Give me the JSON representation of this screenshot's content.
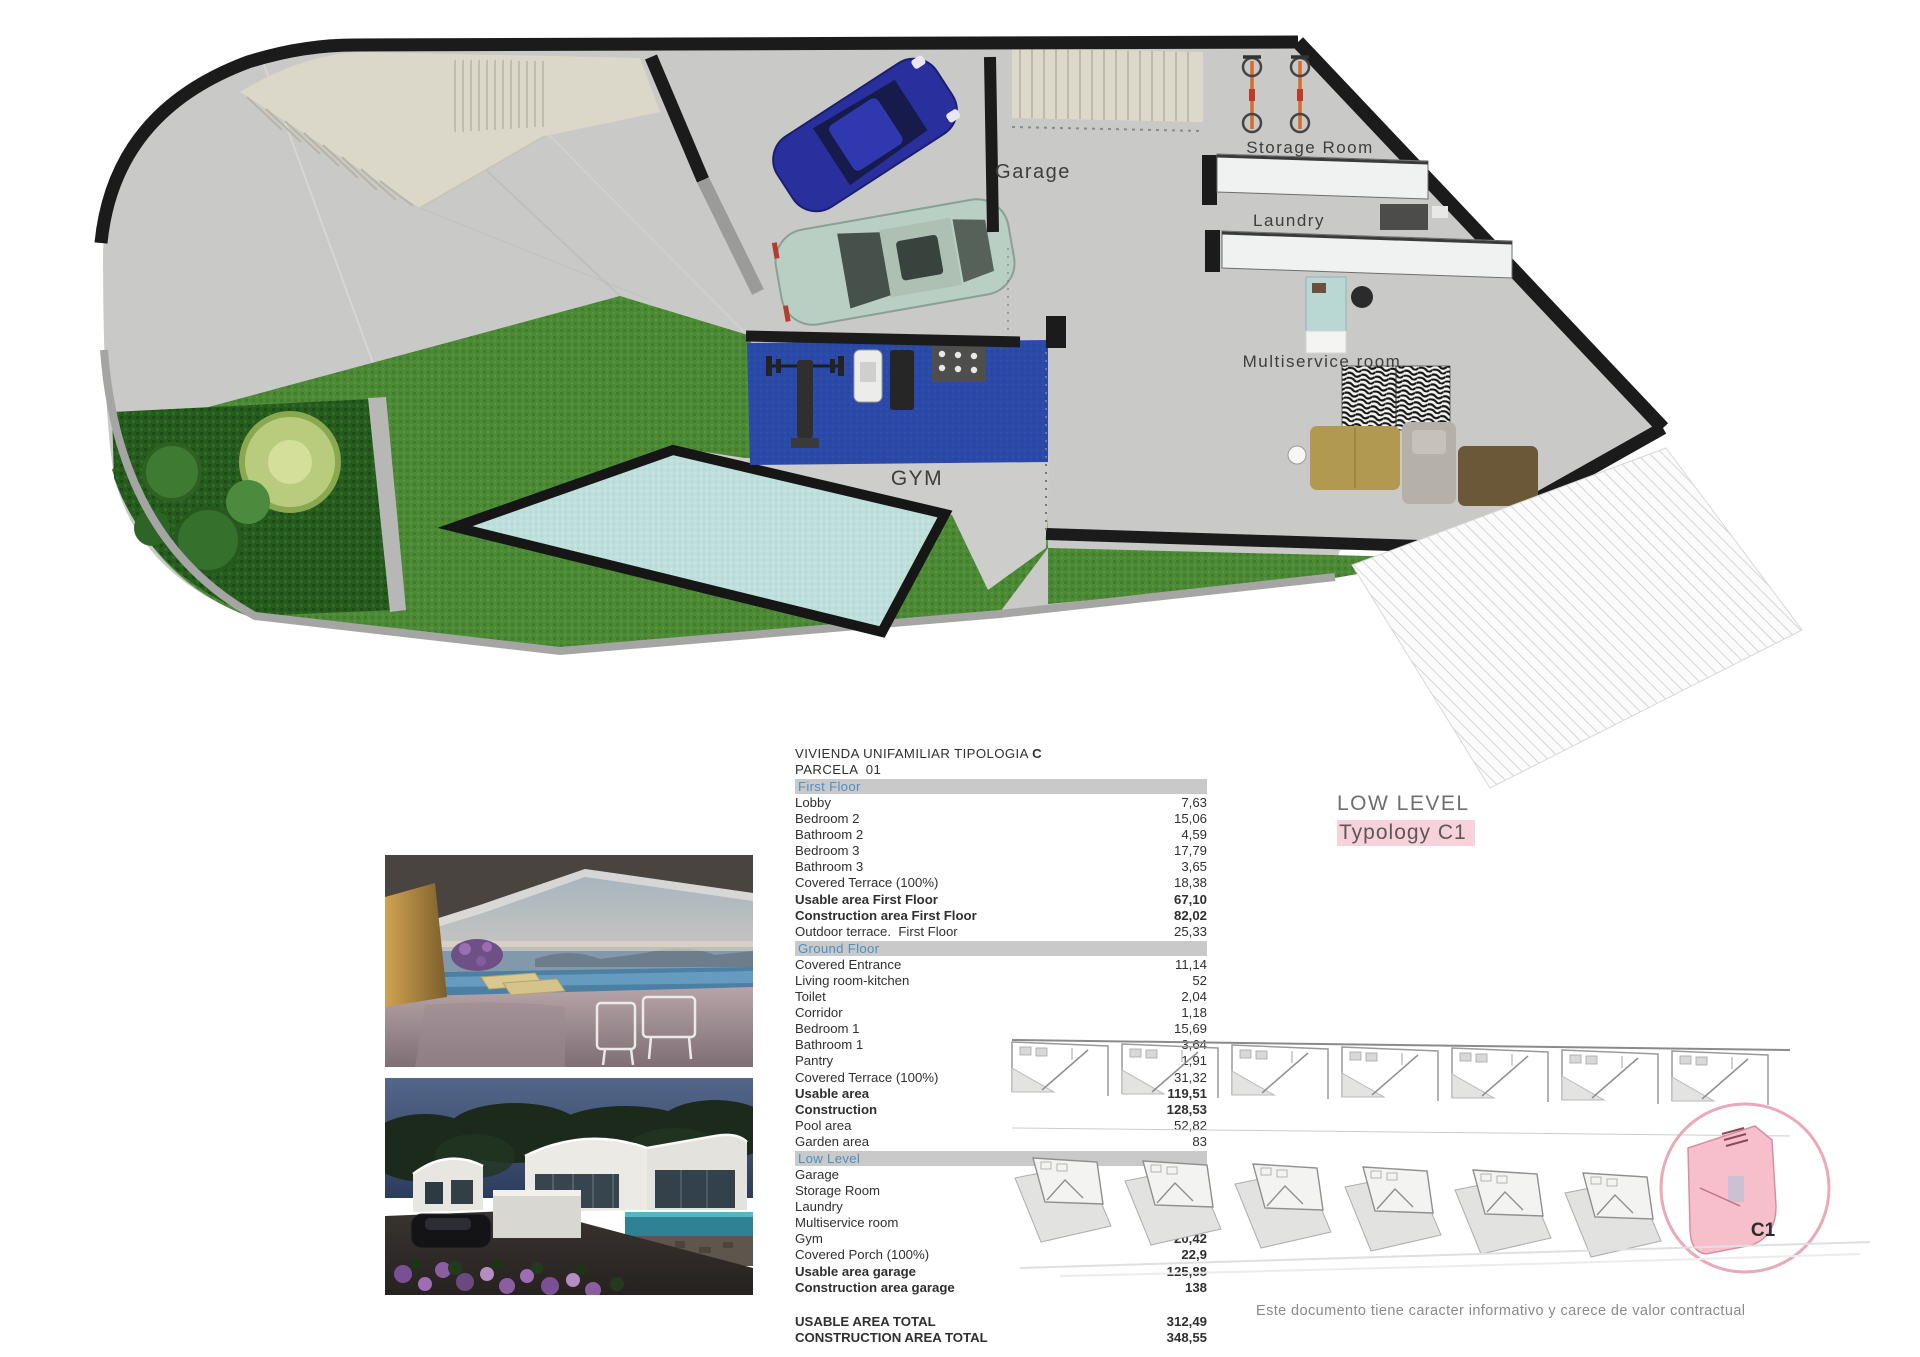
{
  "plan": {
    "labels": {
      "garage": "Garage",
      "storage": "Storage Room",
      "laundry": "Laundry",
      "multiservice": "Multiservice room",
      "gym": "GYM"
    }
  },
  "area_table": {
    "title": "VIVIENDA UNIFAMILIAR TIPOLOGIA",
    "typology": "C",
    "subtitle": "PARCELA  01",
    "sections": [
      {
        "name": "First Floor",
        "rows": [
          {
            "label": "Lobby",
            "value": "7,63",
            "bold": "none"
          },
          {
            "label": "Bedroom 2",
            "value": "15,06",
            "bold": "none"
          },
          {
            "label": "Bathroom 2",
            "value": "4,59",
            "bold": "none"
          },
          {
            "label": "Bedroom 3",
            "value": "17,79",
            "bold": "none"
          },
          {
            "label": "Bathroom 3",
            "value": "3,65",
            "bold": "none"
          },
          {
            "label": "Covered Terrace (100%)",
            "value": "18,38",
            "bold": "none"
          },
          {
            "label": "Usable area First Floor",
            "value": "67,10",
            "bold": "both"
          },
          {
            "label": "Construction area First Floor",
            "value": "82,02",
            "bold": "both"
          },
          {
            "label": "Outdoor terrace.  First Floor",
            "value": "25,33",
            "bold": "none"
          }
        ]
      },
      {
        "name": "Ground Floor",
        "rows": [
          {
            "label": "Covered Entrance",
            "value": "11,14",
            "bold": "none"
          },
          {
            "label": "Living room-kitchen",
            "value": "52",
            "bold": "none"
          },
          {
            "label": "Toilet",
            "value": "2,04",
            "bold": "none"
          },
          {
            "label": "Corridor",
            "value": "1,18",
            "bold": "none"
          },
          {
            "label": "Bedroom 1",
            "value": "15,69",
            "bold": "none"
          },
          {
            "label": "Bathroom 1",
            "value": "3,64",
            "bold": "none"
          },
          {
            "label": "Pantry",
            "value": "1,91",
            "bold": "none"
          },
          {
            "label": "Covered Terrace (100%)",
            "value": "31,32",
            "bold": "none"
          },
          {
            "label": "Usable area",
            "value": "119,51",
            "bold": "both"
          },
          {
            "label": "Construction",
            "value": "128,53",
            "bold": "both"
          },
          {
            "label": "Pool area",
            "value": "52,82",
            "bold": "none"
          },
          {
            "label": "Garden area",
            "value": "83",
            "bold": "none"
          }
        ]
      },
      {
        "name": "Low Level",
        "rows": [
          {
            "label": "Garage",
            "value": "42,3",
            "bold": "none"
          },
          {
            "label": "Storage Room",
            "value": "5,37",
            "bold": "none"
          },
          {
            "label": "Laundry",
            "value": "6,36",
            "bold": "value"
          },
          {
            "label": "Multiservice room",
            "value": "28,53",
            "bold": "value"
          },
          {
            "label": "Gym",
            "value": "20,42",
            "bold": "value"
          },
          {
            "label": "Covered Porch (100%)",
            "value": "22,9",
            "bold": "value"
          },
          {
            "label": "Usable area garage",
            "value": "125,88",
            "bold": "both"
          },
          {
            "label": "Construction area garage",
            "value": "138",
            "bold": "both"
          }
        ]
      }
    ],
    "totals": [
      {
        "label": "USABLE AREA TOTAL",
        "value": "312,49",
        "bold": "both"
      },
      {
        "label": "CONSTRUCTION AREA TOTAL",
        "value": "348,55",
        "bold": "both"
      }
    ]
  },
  "level_caption": {
    "line1": "LOW LEVEL",
    "line2": "Typology C1"
  },
  "siteplan": {
    "highlight_label": "C1"
  },
  "disclaimer": "Este documento tiene caracter informativo y carece de valor contractual",
  "colors": {
    "section_header_text": "#4f8fc0",
    "section_header_bg": "#c9c9c9",
    "typology_highlight": "#f8d2da",
    "siteplan_highlight": "#f7bfcb",
    "grass": "#4c8a36",
    "pool": "#bedfdc",
    "gym_mat": "#2b4aa8",
    "wall": "#1b1b1b"
  }
}
